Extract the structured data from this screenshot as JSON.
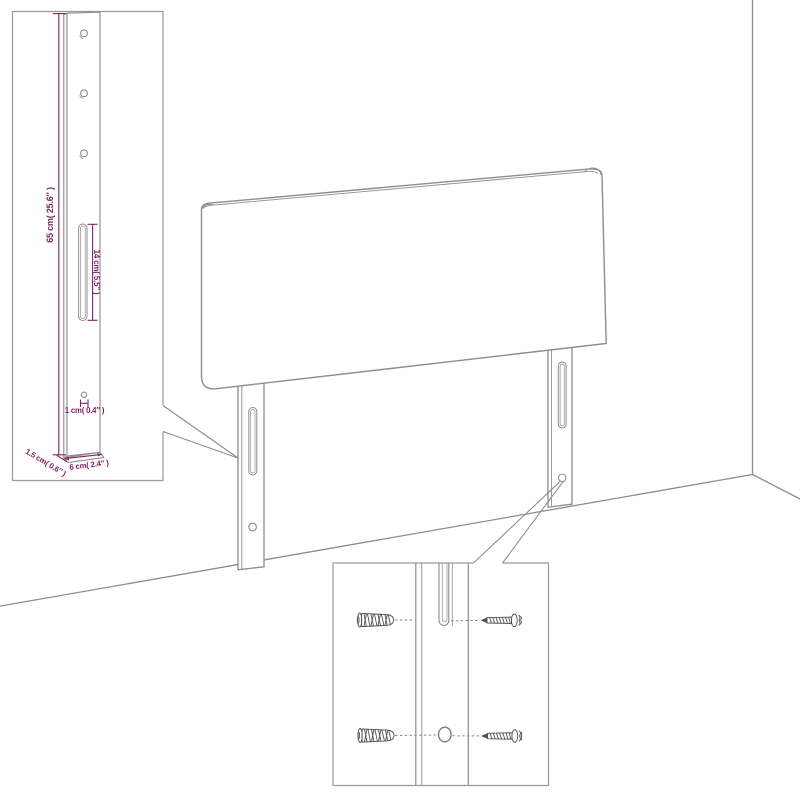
{
  "diagram": {
    "subject": "headboard-wall-mounting-diagram",
    "colors": {
      "outline_gray": "#8d8d8d",
      "dimension_magenta": "#7e2260",
      "hardware_dark": "#4f4f4f",
      "background": "#ffffff"
    },
    "leg_detail_inset": {
      "dimensions": {
        "leg_height": "65 cm( 25.6″ )",
        "slot_length": "14 cm( 5.5″ )",
        "hole_diameter": "1 cm( 0.4″ )",
        "leg_thickness": "1.5 cm( 0.6″ )",
        "leg_width": "6 cm( 2.4″ )"
      }
    },
    "mounting_detail_inset": {
      "parts": {
        "wall_plug": "wall-plug",
        "screw": "screw",
        "slot": "mounting-slot",
        "hole": "mounting-hole"
      }
    }
  }
}
